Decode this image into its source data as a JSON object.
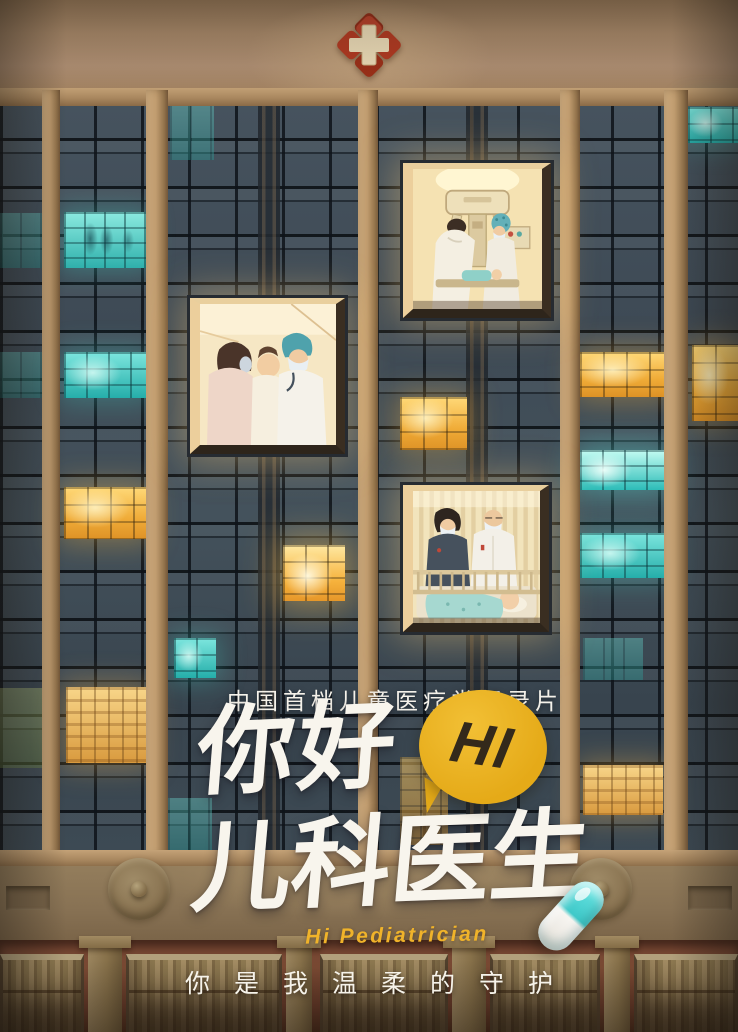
{
  "poster": {
    "subtitle": "中国首档儿童医疗类纪录片",
    "title_line1": "你好",
    "bubble_text": "HI",
    "title_line2": "儿科医生",
    "english_title": "Hi Pediatrician",
    "tagline": "你是我温柔的守护"
  },
  "colors": {
    "kraft_paper": "#a8896a",
    "pillar_tan": "#c09c6f",
    "glass_dark": "#414e59",
    "lit_yellow": "#f2b23c",
    "lit_cyan": "#3cc6c0",
    "cross_red": "#b23a22",
    "cross_cream": "#ecdcb8",
    "title_white": "#f8f5ed",
    "bubble_yellow": "#e5aa18",
    "bubble_text_dark": "#33291b",
    "english_gold": "#f0b32a",
    "brick_red": "#6e4130",
    "stucco": "#887254",
    "capsule_cyan": "#3fc9c9",
    "capsule_white": "#f7f5f1"
  },
  "building": {
    "pillars": [
      {
        "x": 42,
        "w": 18
      },
      {
        "x": 146,
        "w": 22
      },
      {
        "x": 358,
        "w": 20
      },
      {
        "x": 560,
        "w": 20
      },
      {
        "x": 664,
        "w": 24
      }
    ],
    "lit_windows": [
      {
        "x": 0,
        "y": 213,
        "w": 42,
        "h": 55,
        "kind": "cyan-dim"
      },
      {
        "x": 0,
        "y": 352,
        "w": 42,
        "h": 46,
        "kind": "cyan-dim"
      },
      {
        "x": 0,
        "y": 688,
        "w": 42,
        "h": 80,
        "kind": "green-dim"
      },
      {
        "x": 64,
        "y": 212,
        "w": 82,
        "h": 56,
        "kind": "cyan-room"
      },
      {
        "x": 64,
        "y": 352,
        "w": 82,
        "h": 46,
        "kind": "cyan"
      },
      {
        "x": 64,
        "y": 487,
        "w": 82,
        "h": 52,
        "kind": "yellow"
      },
      {
        "x": 66,
        "y": 687,
        "w": 80,
        "h": 76,
        "kind": "yellow-room"
      },
      {
        "x": 170,
        "y": 104,
        "w": 44,
        "h": 56,
        "kind": "cyan-dim"
      },
      {
        "x": 283,
        "y": 545,
        "w": 62,
        "h": 56,
        "kind": "yellow-bright"
      },
      {
        "x": 174,
        "y": 638,
        "w": 42,
        "h": 40,
        "kind": "cyan"
      },
      {
        "x": 168,
        "y": 798,
        "w": 44,
        "h": 54,
        "kind": "cyan-dim"
      },
      {
        "x": 400,
        "y": 397,
        "w": 67,
        "h": 53,
        "kind": "yellow"
      },
      {
        "x": 400,
        "y": 757,
        "w": 48,
        "h": 88,
        "kind": "yellow-dim"
      },
      {
        "x": 580,
        "y": 352,
        "w": 86,
        "h": 45,
        "kind": "yellow"
      },
      {
        "x": 580,
        "y": 450,
        "w": 86,
        "h": 40,
        "kind": "cyan-bright"
      },
      {
        "x": 580,
        "y": 533,
        "w": 86,
        "h": 45,
        "kind": "cyan"
      },
      {
        "x": 583,
        "y": 638,
        "w": 60,
        "h": 42,
        "kind": "cyan-dim"
      },
      {
        "x": 583,
        "y": 765,
        "w": 80,
        "h": 50,
        "kind": "yellow-room"
      },
      {
        "x": 688,
        "y": 107,
        "w": 50,
        "h": 36,
        "kind": "cyan"
      },
      {
        "x": 692,
        "y": 345,
        "w": 46,
        "h": 76,
        "kind": "yellow"
      }
    ],
    "base": {
      "piers": [
        {
          "x": 88,
          "w": 34
        },
        {
          "x": 286,
          "w": 26
        },
        {
          "x": 452,
          "w": 34
        },
        {
          "x": 604,
          "w": 26
        }
      ],
      "windows": [
        {
          "x": 0,
          "w": 84
        },
        {
          "x": 126,
          "w": 156
        },
        {
          "x": 320,
          "w": 128
        },
        {
          "x": 490,
          "w": 110
        },
        {
          "x": 634,
          "w": 104
        }
      ]
    }
  },
  "scenes": [
    {
      "name": "clinic-exam-scene",
      "x": 190,
      "y": 298,
      "w": 155,
      "h": 156,
      "description": "doctor in teal surgical cap examining a baby held by its mother"
    },
    {
      "name": "operating-room-scene",
      "x": 403,
      "y": 163,
      "w": 148,
      "h": 155,
      "description": "two medical staff working over an infant beneath overhead equipment"
    },
    {
      "name": "ward-crib-scene",
      "x": 403,
      "y": 485,
      "w": 146,
      "h": 147,
      "description": "nurse and senior doctor watching a baby sleeping in a crib"
    }
  ]
}
